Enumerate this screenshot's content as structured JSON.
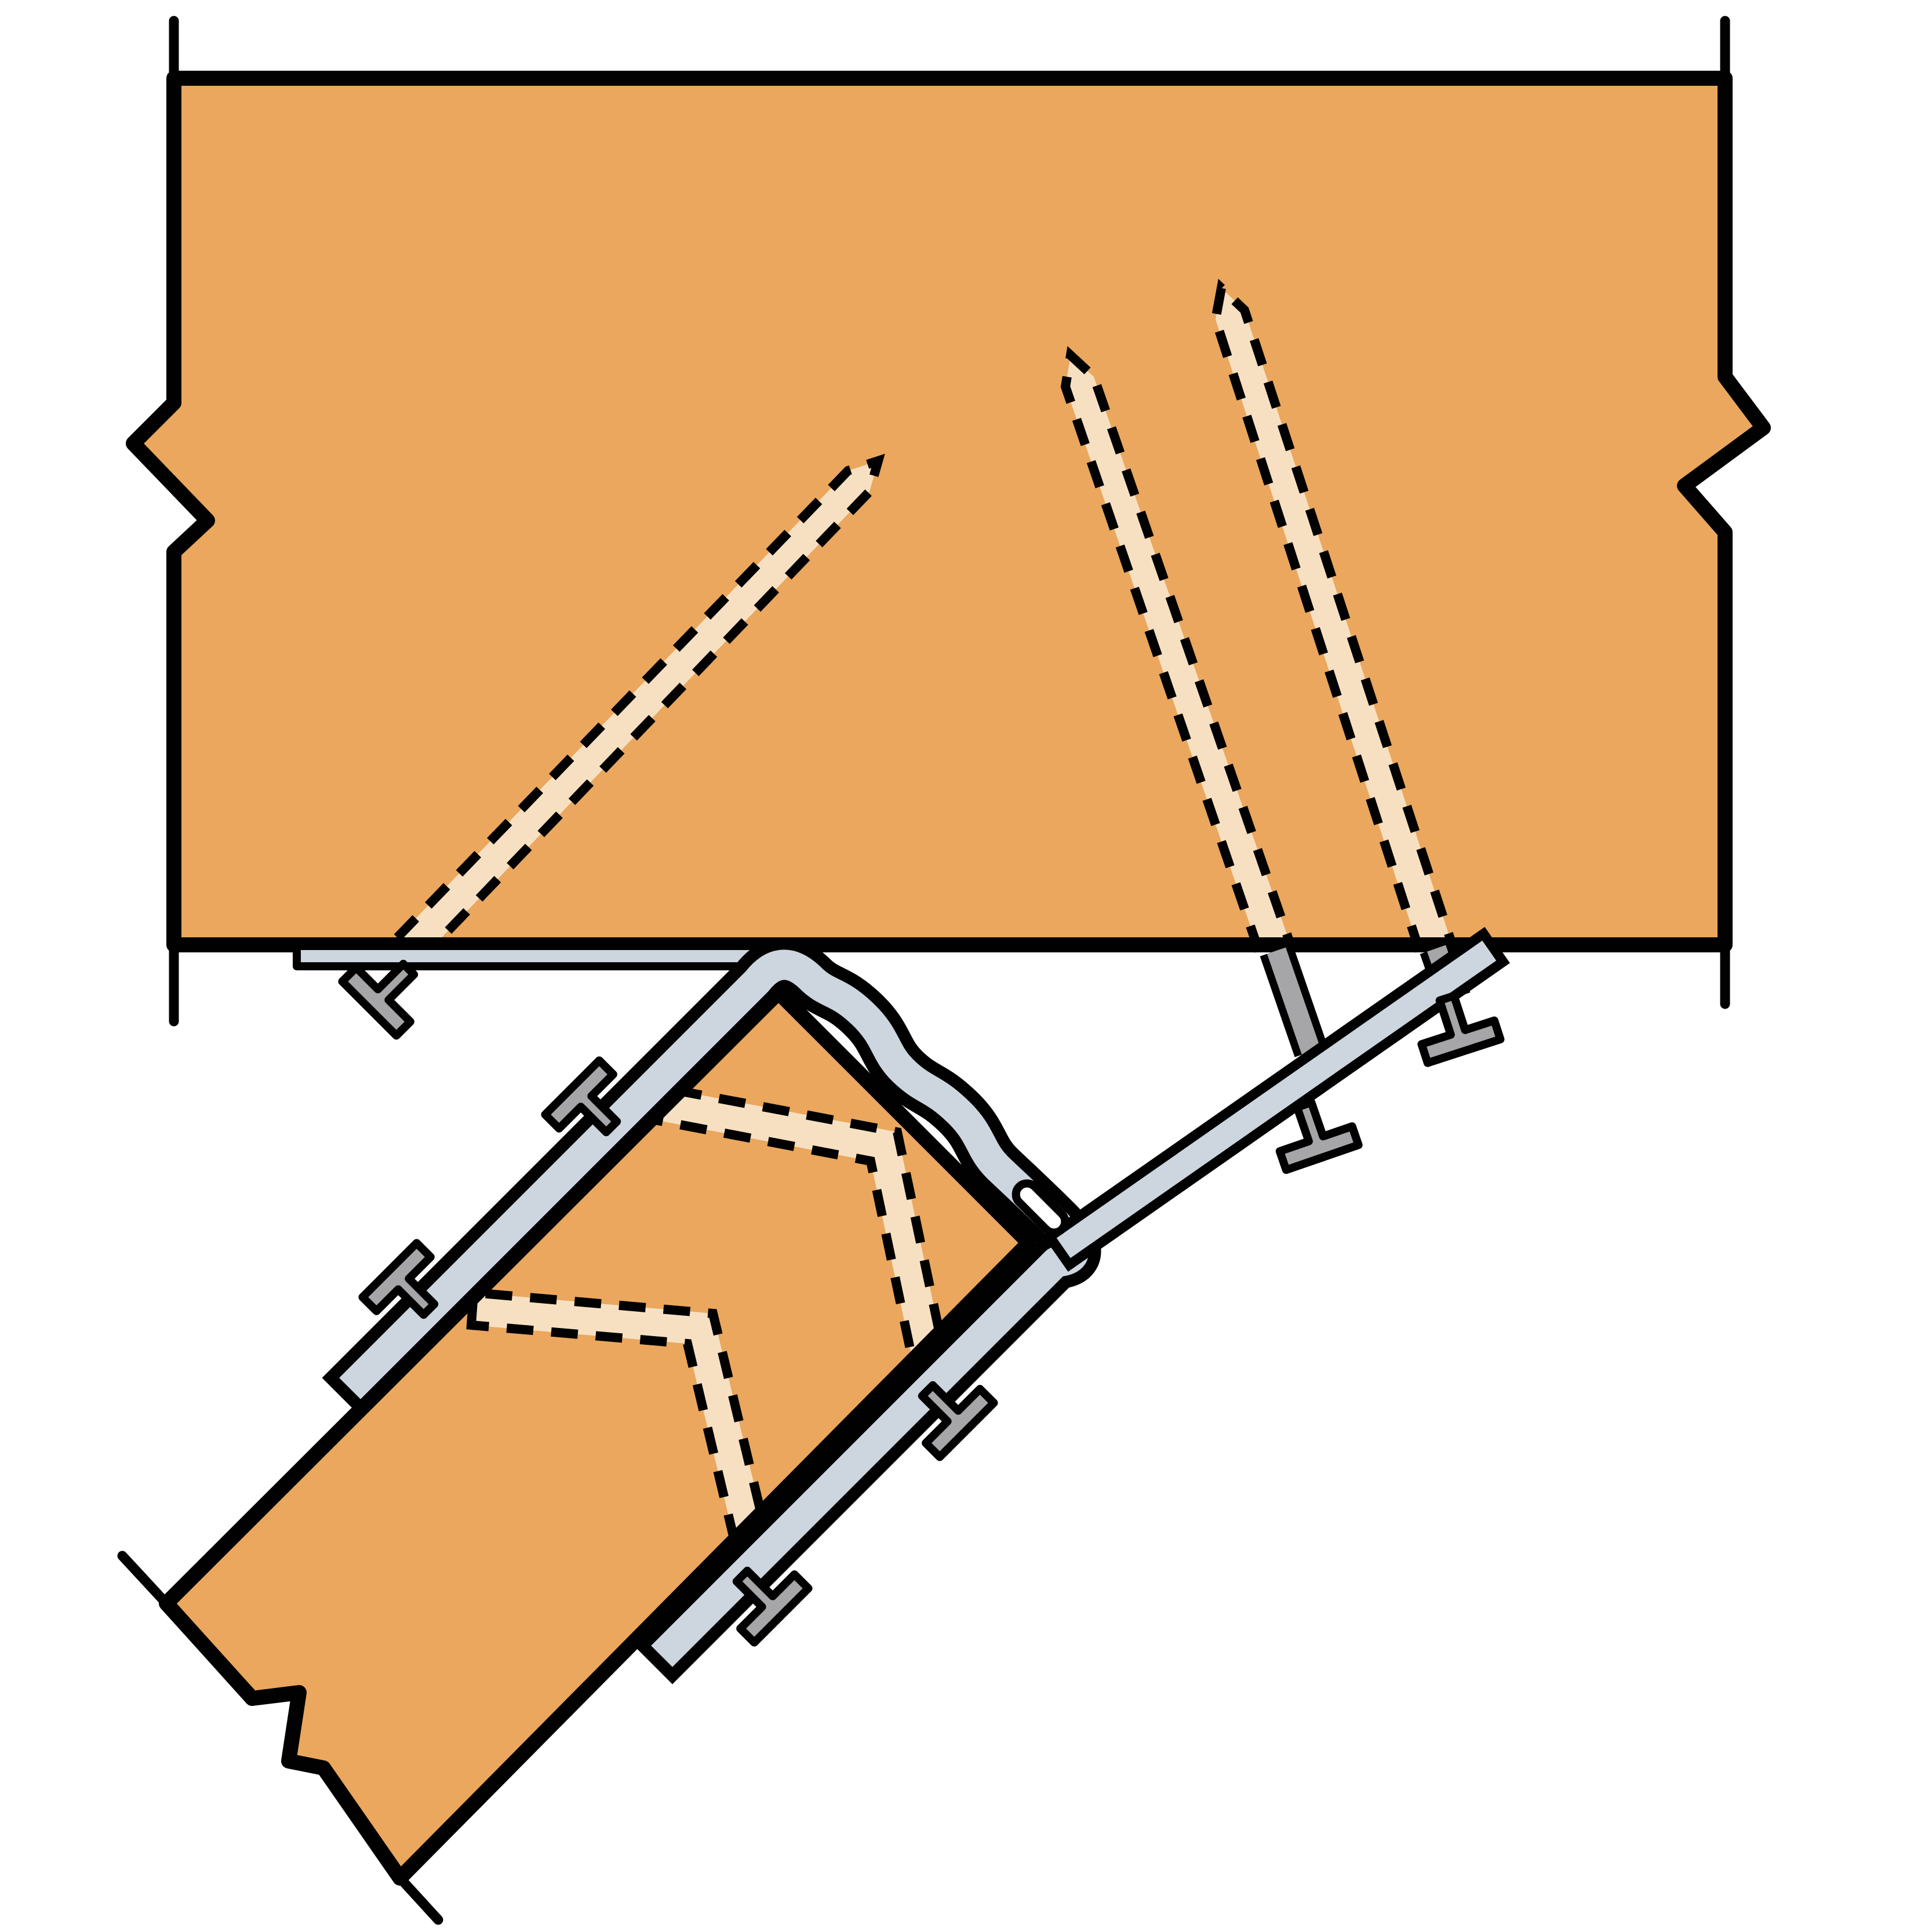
{
  "diagram": {
    "title": "Sloped joist hanger installation detail",
    "description": "Cross-section detail of a sloped joist connected to a header beam with a formed metal joist hanger; hidden fasteners shown with dashed lines",
    "components": {
      "header_beam": "Header / carrying beam (shown broken both sides)",
      "sloped_joist": "Sloped joist (shown broken at lower end)",
      "hanger": "Formed sheet-metal sloped joist hanger with wavy seat tabs and diagonal strap",
      "hanger_slot": "Oblong nailing slot at hanger corner",
      "header_flange": "Hanger top flange nailed to underside of header",
      "diagonal_strap": "Hanger strap anchored to underside of header"
    },
    "fasteners": {
      "hidden_nails_in_header": 3,
      "double_shear_bent_nails_in_joist": 2,
      "visible_nail_heads": 7
    }
  },
  "colors": {
    "bg": "#ffffff",
    "wood": "#EAA75D",
    "nailpath": "#F7E0C2",
    "metal": "#CDD6DF",
    "nail": "#A6A6A9",
    "line": "#010101"
  }
}
